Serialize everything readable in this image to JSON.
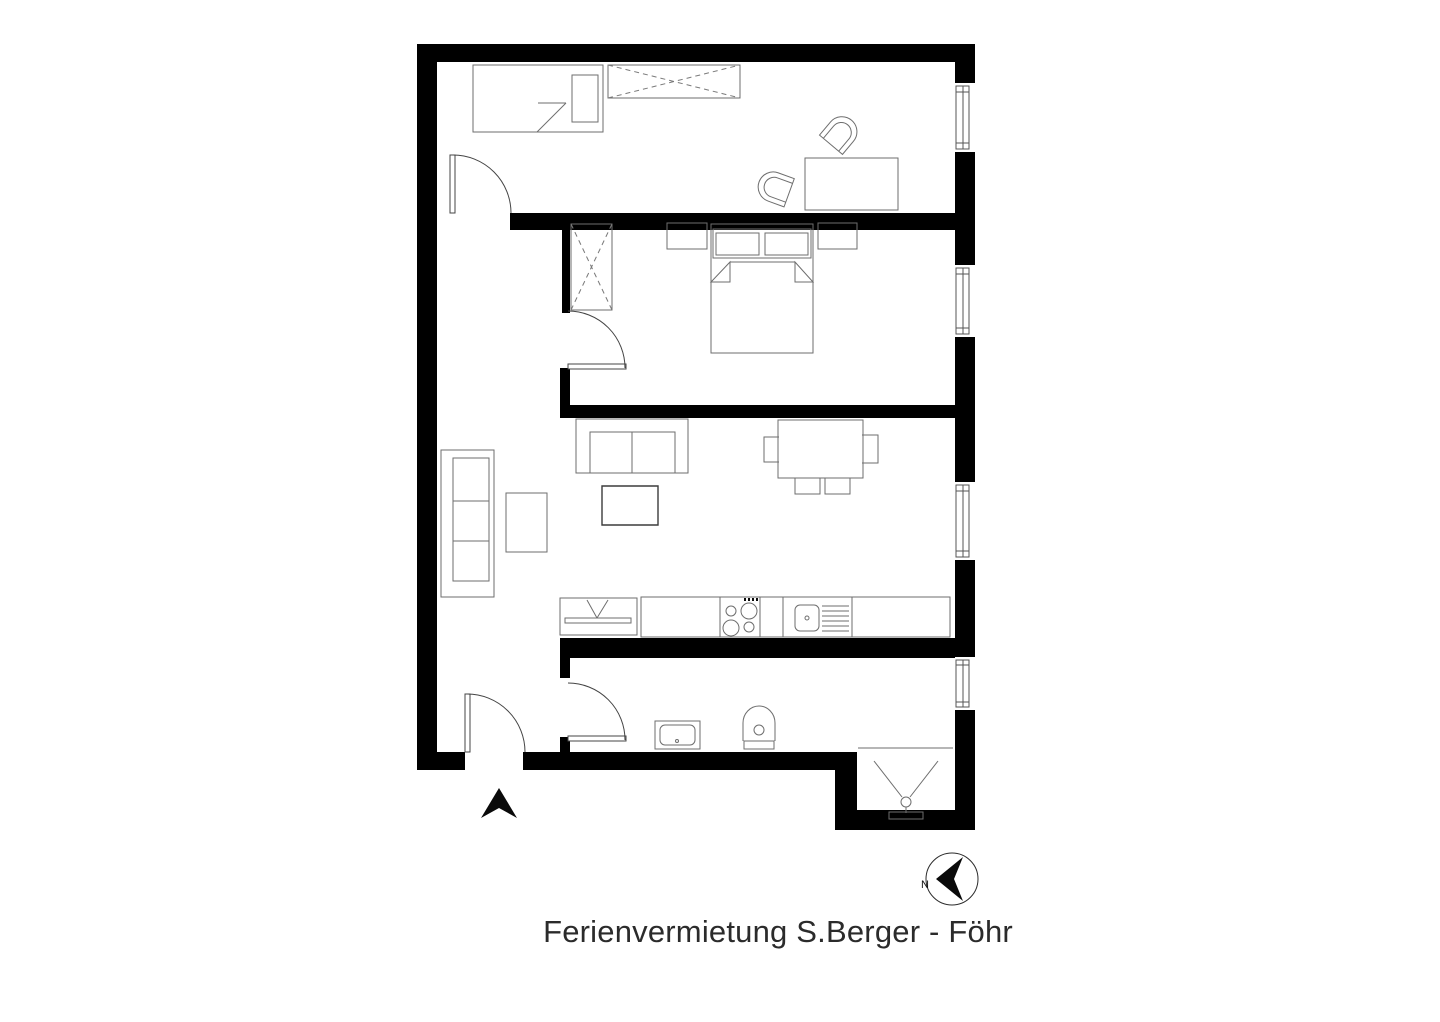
{
  "title": "Ferienvermietung S.Berger - Föhr",
  "compass": {
    "label": "N",
    "needle_points": "left"
  },
  "colors": {
    "wall": "#000000",
    "background": "#ffffff",
    "furniture_outline": "#6e6e6e",
    "text": "#2b2b2b"
  },
  "floorplan": {
    "entrance_marker": "black arrow pointing up at bottom entrance door",
    "rooms": [
      {
        "name": "bedroom-top",
        "furniture": [
          "single-bed",
          "wardrobe-x",
          "desk",
          "shell-chair",
          "shell-chair"
        ],
        "windows": 1,
        "doors": 1
      },
      {
        "name": "bedroom-middle",
        "furniture": [
          "wardrobe-x",
          "nightstand",
          "double-bed",
          "nightstand"
        ],
        "windows": 1,
        "doors": 1
      },
      {
        "name": "living-room-with-kitchen",
        "furniture": [
          "three-seat-sofa",
          "side-table",
          "loveseat",
          "coffee-table",
          "dining-table",
          "dining-chair",
          "dining-chair",
          "dining-chair",
          "dining-chair",
          "tv-board",
          "kitchen-counter",
          "stove-4-burners",
          "sink-with-drainer"
        ],
        "windows": 1
      },
      {
        "name": "bathroom",
        "furniture": [
          "washbasin",
          "toilet",
          "shower"
        ],
        "windows": 1,
        "doors": 1
      },
      {
        "name": "hallway",
        "furniture": [],
        "doors": 4
      }
    ]
  }
}
